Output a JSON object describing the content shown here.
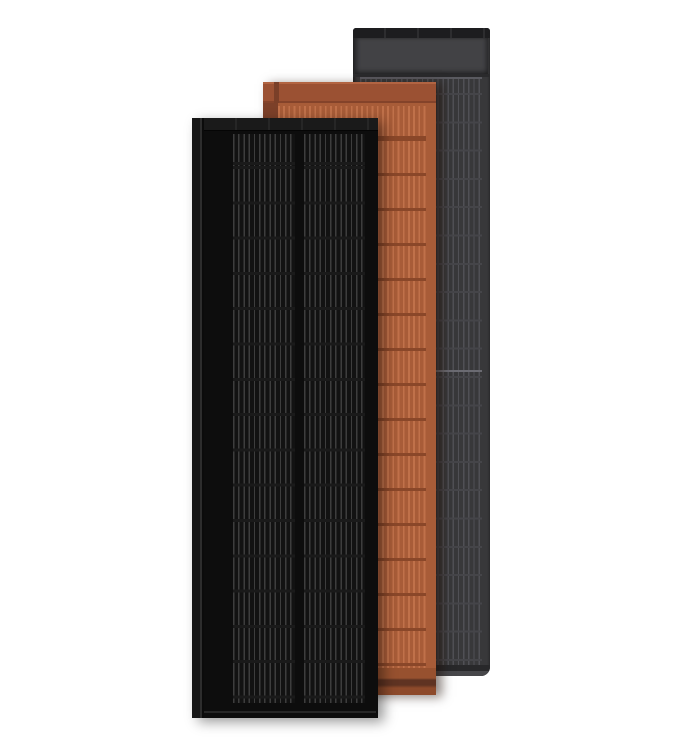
{
  "image": {
    "width": 684,
    "height": 748,
    "background": "#ffffff",
    "description": "Product render of three overlapping solar roof panels standing upright: black panel in front, terracotta panel in middle, dark gray panel behind"
  },
  "panels": [
    {
      "name": "black-solar-panel",
      "position": "front",
      "color_name": "black",
      "face_color": "#0d0d0d",
      "features": [
        "left side rail with seam",
        "top bar",
        "two half-cell grid columns with thin vertical busbar lines",
        "horizontal cell row dividers",
        "solid bottom margin with thin highlight line"
      ]
    },
    {
      "name": "terracotta-solar-panel",
      "position": "middle",
      "color_name": "terracotta",
      "face_color": "#a85c38",
      "features": [
        "solid header band",
        "dark left side rail",
        "cell grid with vertical lines and row dividers",
        "stepped darker footer bands"
      ]
    },
    {
      "name": "gray-solar-panel",
      "position": "back",
      "color_name": "dark gray",
      "face_color": "#38383a",
      "features": [
        "dark top bar",
        "lighter gray header band",
        "cell grid with vertical lines and faint row dividers",
        "bright mid divider",
        "rounded bottom corners with light bottom lip"
      ]
    }
  ],
  "theme": {
    "page_bg": "#ffffff",
    "black_face": "#0d0d0d",
    "black_cell": "#121212",
    "black_rail": "#161616",
    "black_seam": "#2d2d2d",
    "black_topbar": "#1a1a1a",
    "black_line": "#3d3d3d",
    "black_divider": "#1a1a1a",
    "black_bottom_line": "#272727",
    "terra_body": "#a85c38",
    "terra_header": "#9b5133",
    "terra_header_top": "#b26442",
    "terra_header_bottom": "#84432a",
    "terra_seam": "#7a3f28",
    "terra_rail": "#7c4029",
    "terra_line": "#c0714a",
    "terra_divider": "#8a4729",
    "terra_foot1": "#97512f",
    "terra_foot2": "#5f3322",
    "terra_foot3": "#8d4a2b",
    "gray_body": "#38383a",
    "gray_topbar": "#1d1d1f",
    "gray_header": "#424245",
    "gray_sep": "#2a2a2c",
    "gray_highlight": "#5a5a60",
    "gray_line": "#50505",
    "gray_line_fix": "#505055",
    "gray_divider": "#454549",
    "gray_bright": "#6b6b72",
    "gray_foot_dark": "#28282a",
    "gray_foot_light": "#47474a"
  }
}
